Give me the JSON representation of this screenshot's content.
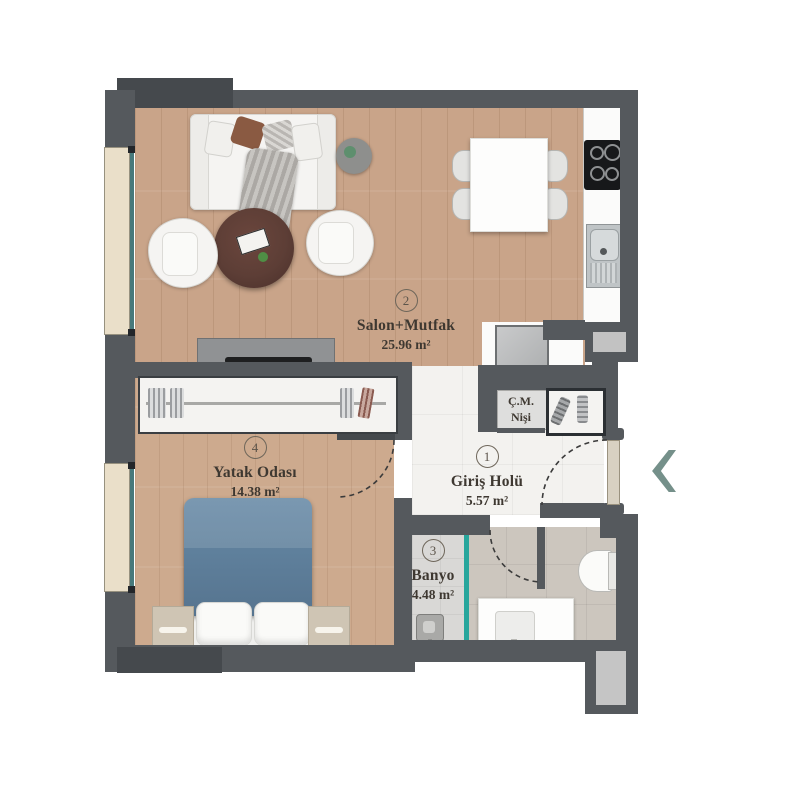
{
  "plan": {
    "rooms": [
      {
        "number": "1",
        "name": "Giriş Holü",
        "area": "5.57 m²"
      },
      {
        "number": "2",
        "name": "Salon+Mutfak",
        "area": "25.96 m²"
      },
      {
        "number": "3",
        "name": "Banyo",
        "area": "4.48 m²"
      },
      {
        "number": "4",
        "name": "Yatak Odası",
        "area": "14.38 m²"
      }
    ],
    "niche": {
      "line1": "Ç.M.",
      "line2": "Nişi"
    },
    "icons": {
      "entrance_arrow": "chevron-left"
    },
    "colors": {
      "wall": "#55595D",
      "wall_dark": "#45494D",
      "wood_salon": "#C9A489",
      "wood_bedroom": "#CDAA8E",
      "hall_tile": "#F3F2EF",
      "bath_tile": "#CCC6BE",
      "shower_tile": "#D9D8D6",
      "glass_teal": "#27A69C",
      "window_sill": "#EADFC9",
      "arrow": "#75908A",
      "text": "#3E3831"
    }
  }
}
